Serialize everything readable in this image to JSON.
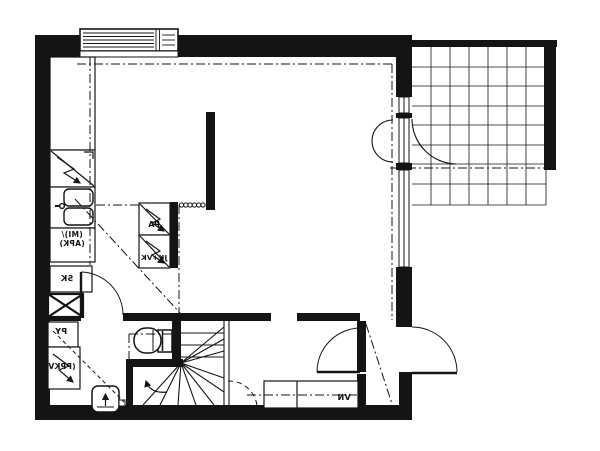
{
  "document": {
    "type": "architectural floor plan (black ink on white paper)",
    "text_mirrored": true
  },
  "colors": {
    "ink": "#141414",
    "paper": "#ffffff"
  },
  "labels": {
    "pa": "PA",
    "jkvk": "JK+VK",
    "miapk": "(MI)/\n(APK)",
    "sk": "SK",
    "py": "PY",
    "ppkv": "(PPKV)",
    "vn": "VN"
  },
  "fixtures": [
    "top-window",
    "right-wall-windows",
    "balcony-tile-grid",
    "balcony-door-swing",
    "kitchen-upper-cabinets",
    "appliance-zigzag",
    "kitchen-sink-double-basin",
    "cleaning-closet",
    "duct-x-box",
    "toilet",
    "washbasin-with-arrow",
    "winder-staircase",
    "stair-direction-arrow",
    "wardrobe-row",
    "bathroom-door-swing",
    "hall-door-swing",
    "entrance-door-swing",
    "radiator-dots",
    "ceiling-height-dashdot-lines"
  ]
}
